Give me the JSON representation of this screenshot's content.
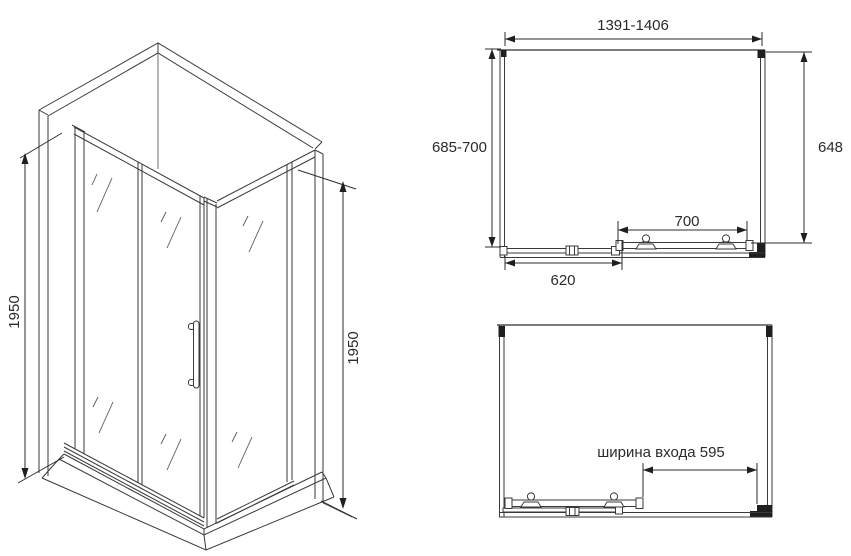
{
  "page": {
    "background": "#ffffff",
    "line_color": "#3a3a3a",
    "text_color": "#2b2b2b",
    "description_type": "shower enclosure dimensional drawing"
  },
  "iso_view": {
    "height_dim_left": "1950",
    "height_dim_right": "1950"
  },
  "plan_closed": {
    "overall_width": "1391-1406",
    "depth_range": "685-700",
    "side_panel": "648",
    "door_width": "700",
    "fixed_panel_width": "620"
  },
  "plan_open": {
    "entrance_width_label": "ширина входа 595"
  }
}
